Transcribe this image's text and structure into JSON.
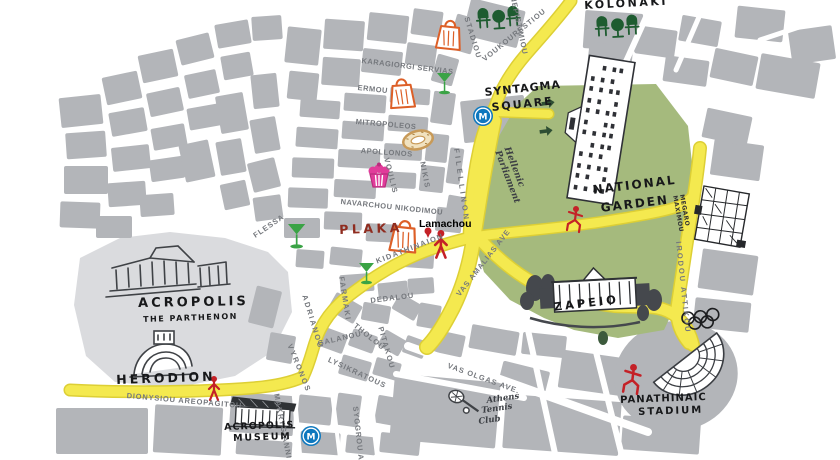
{
  "colors": {
    "block": "#b3b5b9",
    "hill": "#dadbde",
    "garden": "#a5ba7d",
    "road": "#f4e94f",
    "road_edge": "#ddcf35",
    "metro": "#0e78be",
    "red": "#c42127",
    "orange": "#dd5f27",
    "martini_green": "#3aa345",
    "cafe_green": "#1e5c30",
    "pink": "#e13c9a",
    "koulouri": "#c89a58",
    "sketch": "#3f4246",
    "rings": "#1c1d1f",
    "arrow_green": "#2e4e33",
    "street_text": "#75787d",
    "poi_text": "#17181a",
    "plaka_text": "#8f2c1f"
  },
  "metro_letter": "M",
  "streets": {
    "karagiorgi": "KARAGIORGI SERVIAS",
    "ermou": "ERMOU",
    "mitropoleos": "MITROPOLEOS",
    "apollonos": "APOLLONOS",
    "navarchou": "NAVARCHOU NIKODIMOU",
    "stadiou": "STADIOU",
    "panepistimiou": "PANEPISTIMIOU",
    "voukourestiou": "VOUKOURESTIOU",
    "filellinon": "FILELLINON",
    "voulis": "VOULIS",
    "nikis": "NIKIS",
    "flessa": "FLESSA",
    "adrianou": "ADRIANOU",
    "farmaki": "FARMAKI",
    "dedalou": "DEDALOU",
    "tholou": "THOLOU",
    "galanou": "GALANOU",
    "pitakou": "PITAKOU",
    "lysikratous": "LYSIKRATOUS",
    "vyronos": "VYRONOS",
    "kidathinaion": "KIDATHINAION",
    "amalias": "VAS AMALIAS AVE",
    "dionysiou": "DIONYSIOU AREOPAGITOU",
    "makrygianni": "MAKRYGIANNI",
    "syggrou": "SYGGROU AVE.",
    "olgas": "VAS OLGAS AVE.",
    "irodou": "IRODOU ATTIKOU"
  },
  "pois": {
    "kolonaki": "KOLONAKI",
    "syntagma1": "SYNTAGMA",
    "syntagma2": "SQUARE",
    "national1": "NATIONAL",
    "national2": "GARDEN",
    "plaka": "PLAKA",
    "lamachou": "Lamachou",
    "acropolis": "ACROPOLIS",
    "parthenon": "THE PARTHENON",
    "herodion": "HERODION",
    "museum1": "ACROPOLIS",
    "museum2": "MUSEUM",
    "zapeio": "ZAPEIO",
    "stadium1": "PANATHINAIC",
    "stadium2": "STADIUM",
    "tennis1": "Athens",
    "tennis2": "Tennis",
    "tennis3": "Club",
    "parliament1": "Hellenic",
    "parliament2": "Parliament",
    "megaro1": "MEGARO",
    "megaro2": "MAXIMOU"
  }
}
